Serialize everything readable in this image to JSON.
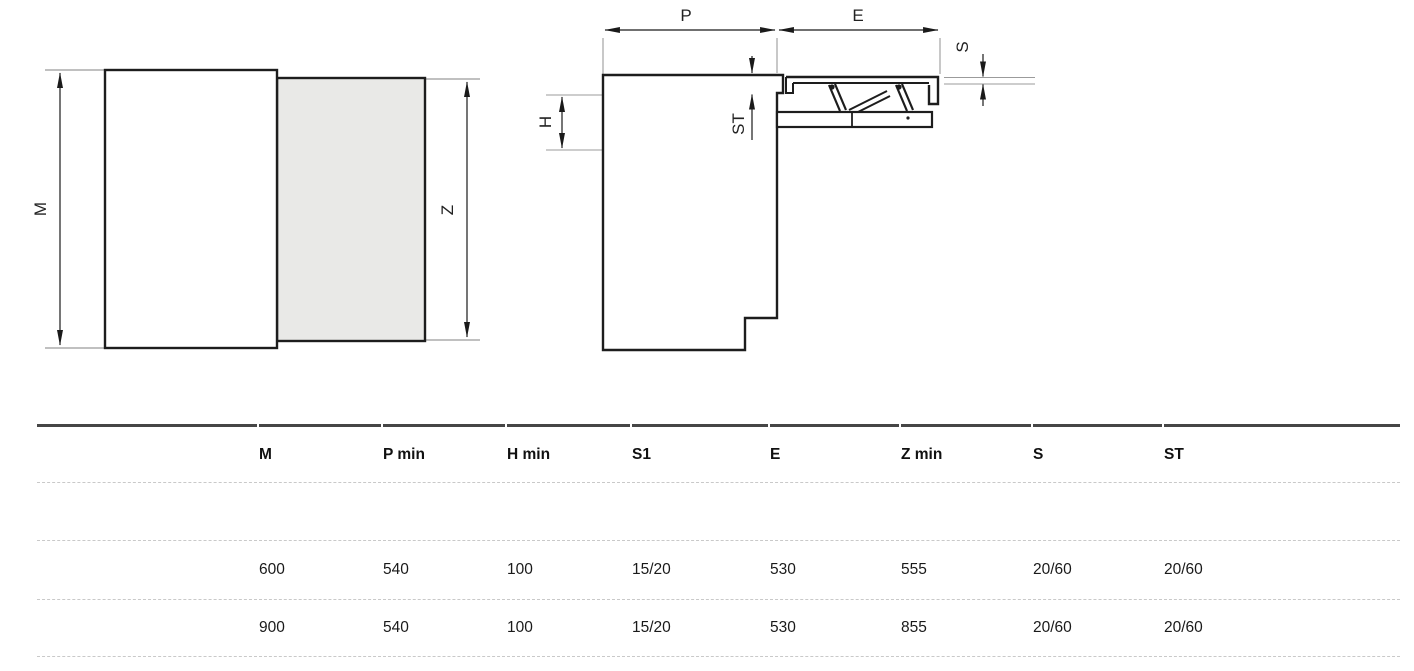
{
  "diagrams": {
    "front_view": {
      "labels": {
        "m": "M",
        "z": "Z"
      }
    },
    "section_view": {
      "labels": {
        "p": "P",
        "e": "E",
        "s": "S",
        "st": "ST",
        "h": "H"
      }
    },
    "colors": {
      "panel_fill": "#e9e9e7",
      "line": "#1a1a1a",
      "guide": "#9b9b9b",
      "table_top_border": "#464646"
    }
  },
  "table": {
    "headers": [
      "",
      "M",
      "P min",
      "H min",
      "S1",
      "E",
      "Z min",
      "S",
      "ST"
    ],
    "rows": [
      [
        "",
        "600",
        "540",
        "100",
        "15/20",
        "530",
        "555",
        "20/60",
        "20/60"
      ],
      [
        "",
        "900",
        "540",
        "100",
        "15/20",
        "530",
        "855",
        "20/60",
        "20/60"
      ]
    ]
  }
}
